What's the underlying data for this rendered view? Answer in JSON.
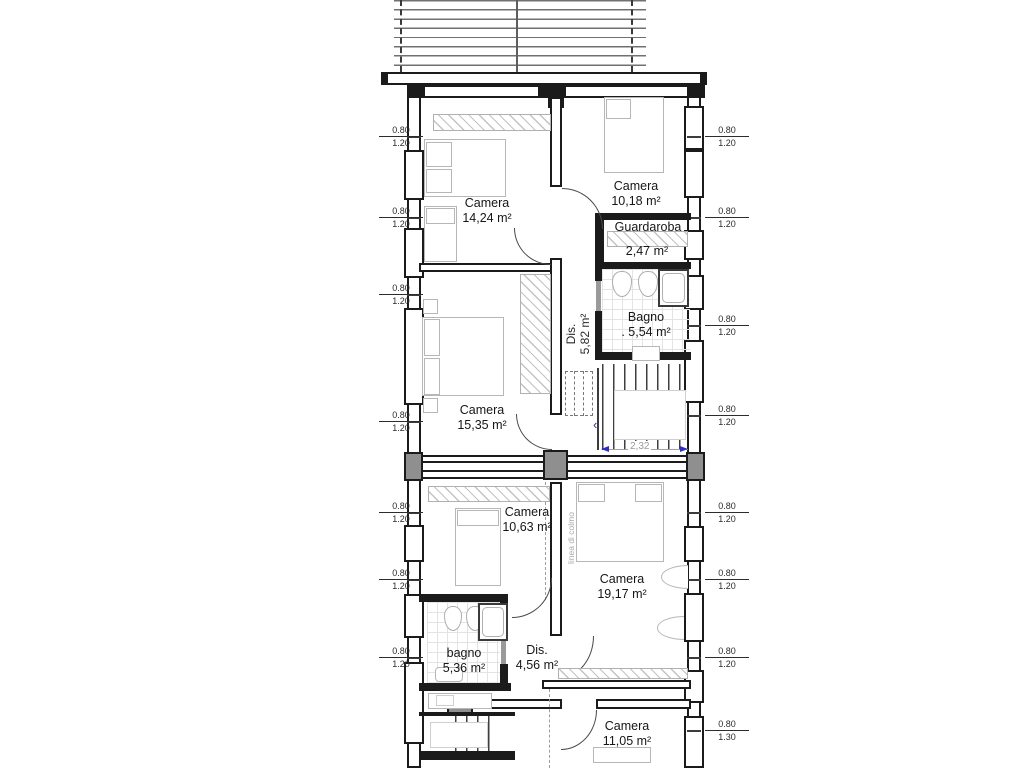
{
  "rooms": {
    "camera1424": {
      "name": "Camera",
      "area": "14,24 m²"
    },
    "camera1018": {
      "name": "Camera",
      "area": "10,18 m²"
    },
    "guardaroba": {
      "name": "Guardaroba",
      "area": "2,47 m²"
    },
    "bagno554": {
      "name": "Bagno",
      "area": ". 5,54 m²"
    },
    "dis582": {
      "name": "Dis.",
      "area": "5,82 m²"
    },
    "camera1535": {
      "name": "Camera",
      "area": "15,35 m²"
    },
    "camera1063": {
      "name": "Camera",
      "area": "10,63 m²"
    },
    "camera1917": {
      "name": "Camera",
      "area": "19,17 m²"
    },
    "bagno536": {
      "name": "bagno",
      "area": "5,36 m²"
    },
    "dis456": {
      "name": "Dis.",
      "area": "4,56 m²"
    },
    "camera1105": {
      "name": "Camera",
      "area": "11,05 m²"
    }
  },
  "windows": {
    "standard": {
      "width": "0.80",
      "height": "1.20"
    },
    "tall": {
      "width": "0.80",
      "height": "1.30"
    }
  },
  "dimensions": {
    "stair_width": "2,32"
  },
  "annotations": {
    "ridge_line": "linea di colmo"
  },
  "colors": {
    "wall": "#1b1b1b",
    "furniture": "#b7b7b7",
    "tile_grid": "#e3e3e3",
    "dimension_arrow": "#2d2dc8",
    "dimension_text": "#9a9a9a"
  }
}
